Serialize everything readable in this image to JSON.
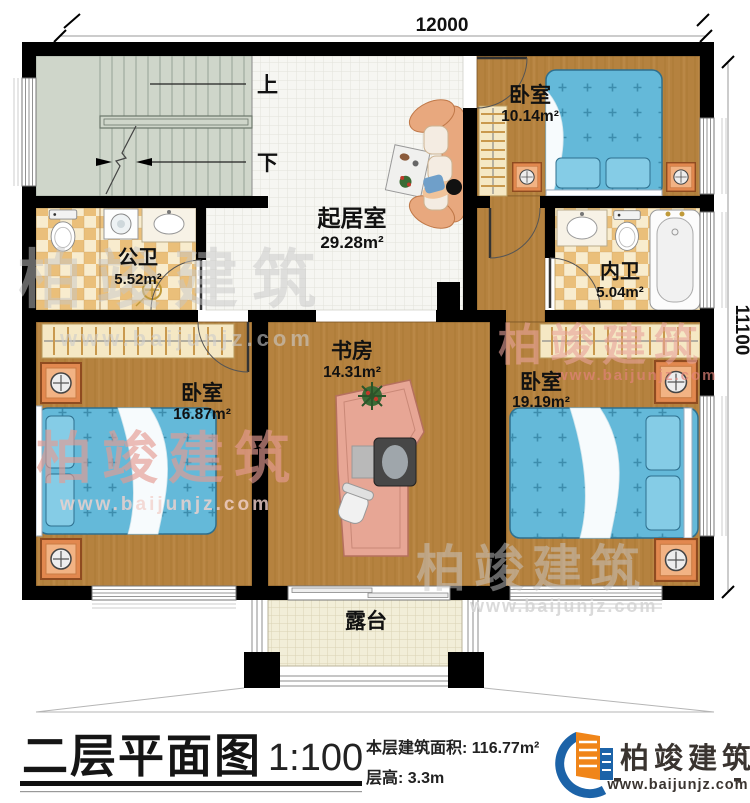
{
  "plan": {
    "dim_top": "12000",
    "dim_right": "11100",
    "stair_up": "上",
    "stair_down": "下",
    "rooms": {
      "bedroom_top": {
        "name": "卧室",
        "area": "10.14m²"
      },
      "living": {
        "name": "起居室",
        "area": "29.28m²"
      },
      "public_bath": {
        "name": "公卫",
        "area": "5.52m²"
      },
      "inner_bath": {
        "name": "内卫",
        "area": "5.04m²"
      },
      "bedroom_left": {
        "name": "卧室",
        "area": "16.87m²"
      },
      "study": {
        "name": "书房",
        "area": "14.31m²"
      },
      "bedroom_right": {
        "name": "卧室",
        "area": "19.19m²"
      },
      "terrace": {
        "name": "露台"
      }
    }
  },
  "watermark": {
    "brand": "柏竣建筑",
    "url": "www.baijunjz.com"
  },
  "title_block": {
    "title": "二层平面图",
    "scale": "1:100",
    "floor_area": "本层建筑面积: 116.77m²",
    "floor_height": "层高: 3.3m"
  },
  "logo": {
    "brand": "柏竣建筑",
    "url": "www.baijunjz.com"
  },
  "colors": {
    "wall": "#000000",
    "wood": "#b5823f",
    "tile": "#f6f6f2",
    "stair": "#cfd6ca",
    "checker": "#eabf7a",
    "bed_blue": "#64b9d9",
    "salmon": "#e8a87e",
    "watermark_red": "#e59b92",
    "logo_blue": "#1c63a8",
    "logo_orange": "#f08519"
  }
}
